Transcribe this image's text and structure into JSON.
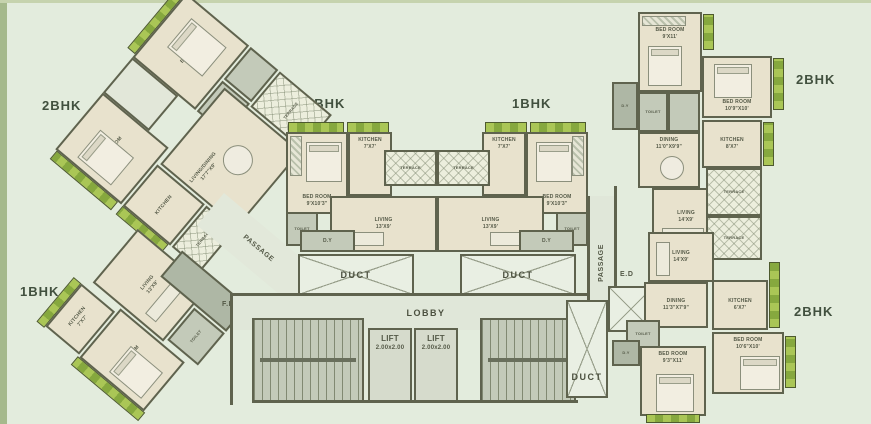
{
  "labels": {
    "bhk2": "2BHK",
    "bhk1": "1BHK",
    "lobby": "LOBBY",
    "lift": "LIFT",
    "lift_dim": "2.00x2.00",
    "duct": "DUCT",
    "passage": "PASSAGE",
    "ed": "E.D",
    "fd": "F.D",
    "dy": "D.Y",
    "terrace": "TERRACE",
    "toilet": "TOILET",
    "bed_room": "BED ROOM",
    "kitchen": "KITCHEN",
    "living": "LIVING",
    "dining": "DINING",
    "living_dining": "LIVING/DINING"
  },
  "dims": {
    "bed_center": "9'X10'3\"",
    "kitchen_center": "7'X7'",
    "living_center": "13'X9'",
    "bed_tr1": "9'X11'",
    "bed_tr2": "10'9\"X10'",
    "kitchen_tr": "8'X7'",
    "dining_tr": "11'0\"X9'9\"",
    "living_r": "14'X9'",
    "dining_br": "11'3\"X7'9\"",
    "kitchen_br": "6'X7'",
    "bed_br1": "10'6\"X10'",
    "bed_br2": "9'3\"X11'",
    "livdin_tl": "17'7\"X9'"
  },
  "colors": {
    "background": "#e3ecdd",
    "wall": "#5f634e",
    "room_beige": "#e8e2cd",
    "room_light": "#e2e7d9",
    "gray": "#c3cab9",
    "planter_green": "#86a83e",
    "planter_light": "#aac656"
  }
}
